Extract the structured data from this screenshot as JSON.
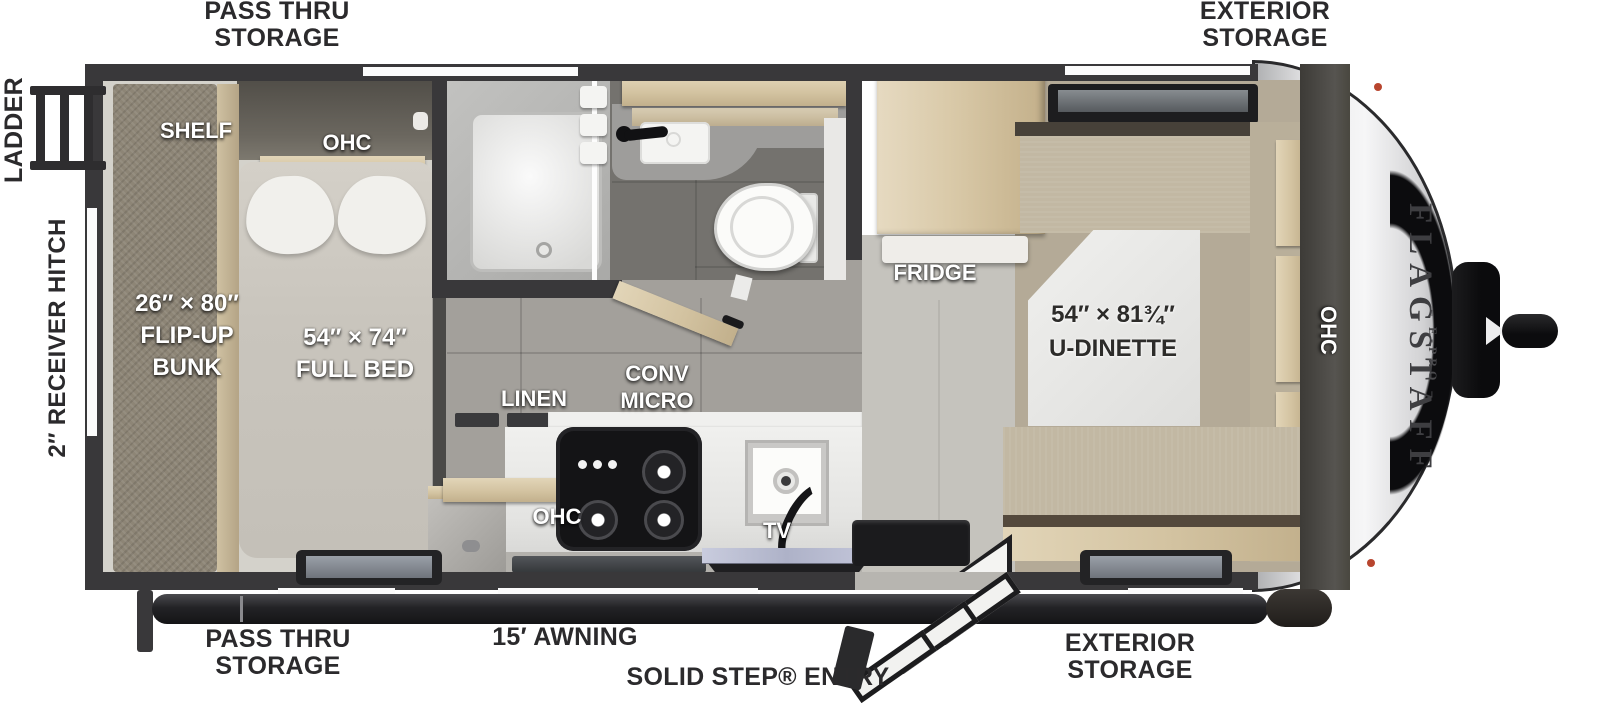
{
  "title": "Flagstaff E-Pro travel trailer floorplan (top view)",
  "brand": {
    "name": "FLAGSTAFF",
    "sub": "– E-PRO –"
  },
  "labels": {
    "pass_thru_1": "PASS THRU",
    "pass_thru_2": "STORAGE",
    "exterior_1": "EXTERIOR",
    "exterior_2": "STORAGE",
    "ladder": "LADDER",
    "hitch": "2″ RECEIVER HITCH",
    "awning": "15′ AWNING",
    "entry": "SOLID STEP® ENTRY",
    "shelf": "SHELF",
    "ohc": "OHC",
    "bunk_dims": "26″ × 80″",
    "bunk_1": "FLIP-UP",
    "bunk_2": "BUNK",
    "bed_dims": "54″ × 74″",
    "bed_name": "FULL BED",
    "fridge": "FRIDGE",
    "linen": "LINEN",
    "conv": "CONV",
    "micro": "MICRO",
    "tv": "TV",
    "dinette_dims": "54″ × 81¾″",
    "dinette_name": "U-DINETTE"
  },
  "colors": {
    "wall": "#39383a",
    "wood": "#d8c9a8",
    "bunk_carpet": "#8d8576",
    "cushion_tan": "#c2b8a3",
    "hall_tile": "#a3a09b",
    "bath_floor": "#74726e",
    "bedroom_floor": "#d4d2cb",
    "entry_floor": "#c5c3bd",
    "counter_white": "#ebebe9",
    "cooktop_black": "#141416",
    "cap_silver": "#e8e8e9",
    "awning_bar": "#232326",
    "label_dark": "#2b2a2c",
    "marker_light": "#b8452e",
    "sink_glass": "#c3c6da"
  }
}
